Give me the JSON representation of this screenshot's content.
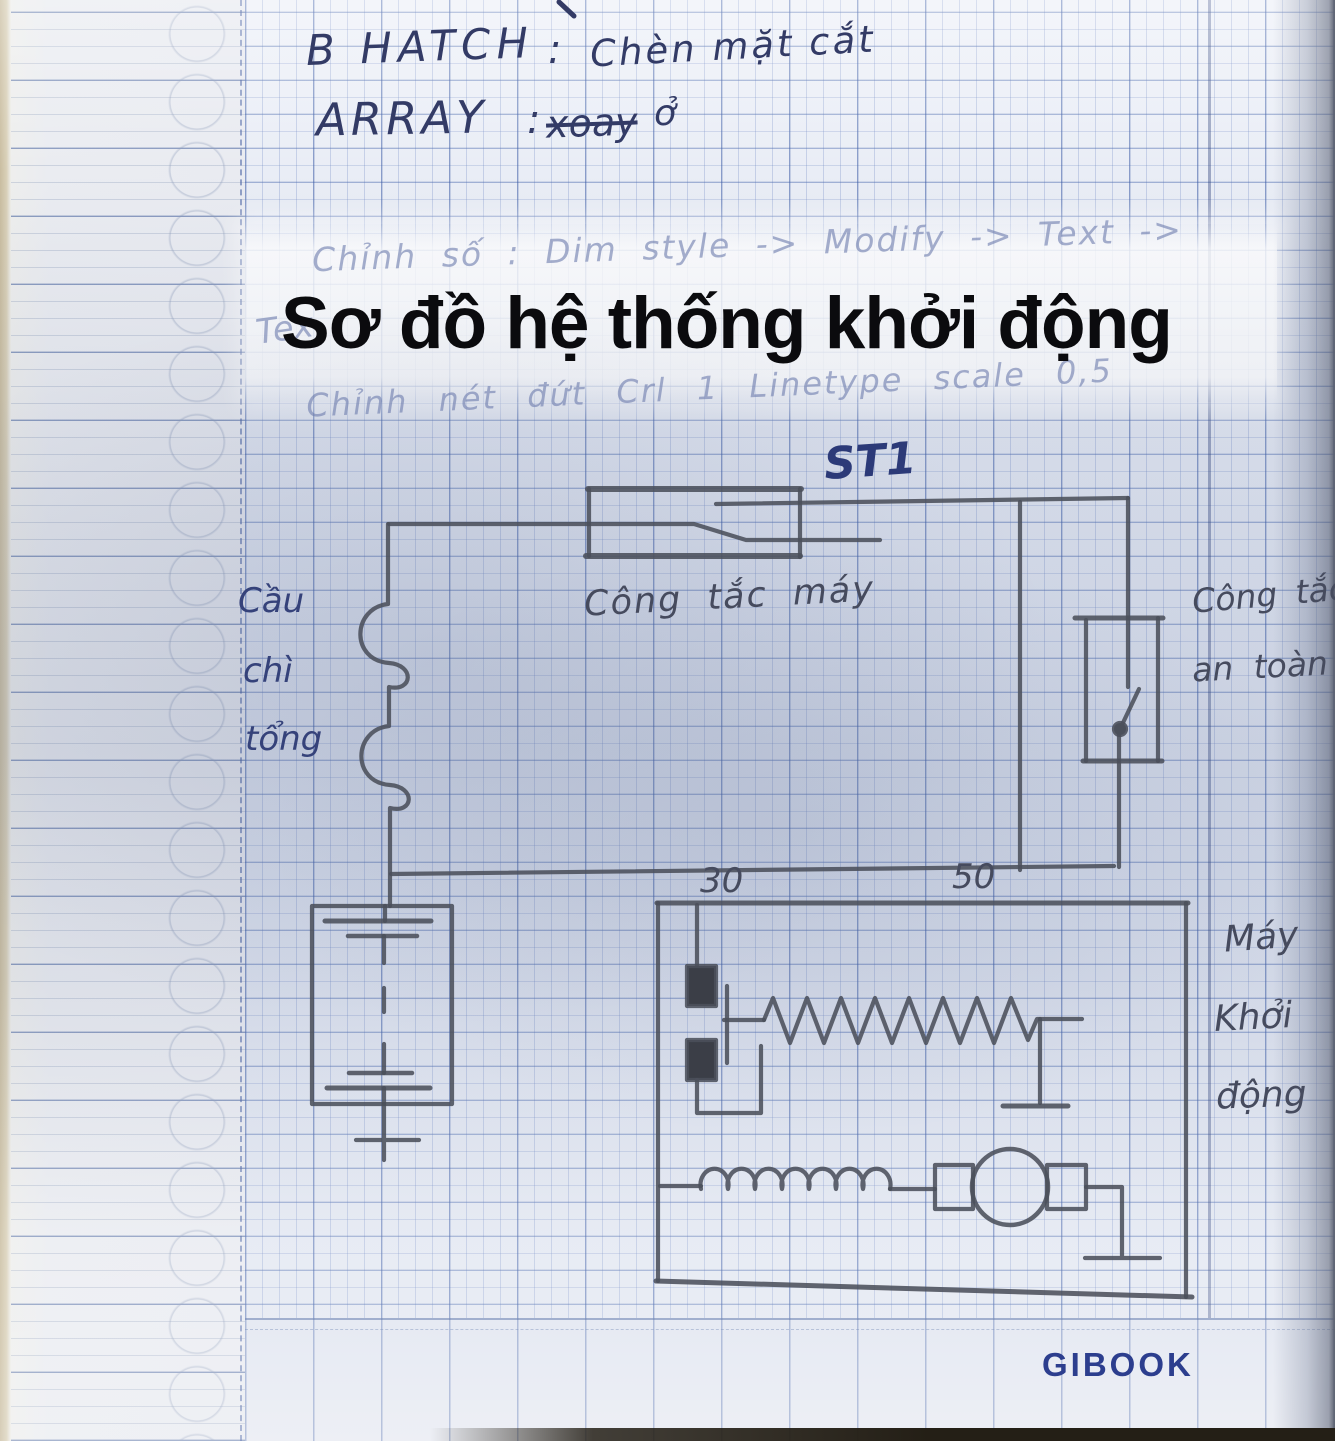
{
  "notes": {
    "line1_label": "B HATCH",
    "line1_sep": ":",
    "line1_text": "Chèn mặt cắt",
    "line2_label": "ARRAY",
    "line2_sep": ":",
    "line2_struck": "xoay",
    "line2_tail": "ở"
  },
  "faded": {
    "line1": "Chỉnh số : Dim style -> Modify -> Text ->",
    "fragment": "Tex",
    "line2": "Chỉnh nét đứt  Crl 1   Linetype scale  0,5"
  },
  "overlay": {
    "title": "Sơ đồ hệ thống khởi động"
  },
  "diagram": {
    "st1": "ST1",
    "ignition_switch": "Công tắc máy",
    "fuse": {
      "l1": "Cầu",
      "l2": "chì",
      "l3": "tổng"
    },
    "safety": {
      "l1": "Công tắc",
      "l2": "an toàn"
    },
    "terminals": {
      "t30": "30",
      "t50": "50"
    },
    "starter": {
      "l1": "Máy",
      "l2": "Khởi",
      "l3": "động"
    }
  },
  "brand": "GIBOOK"
}
